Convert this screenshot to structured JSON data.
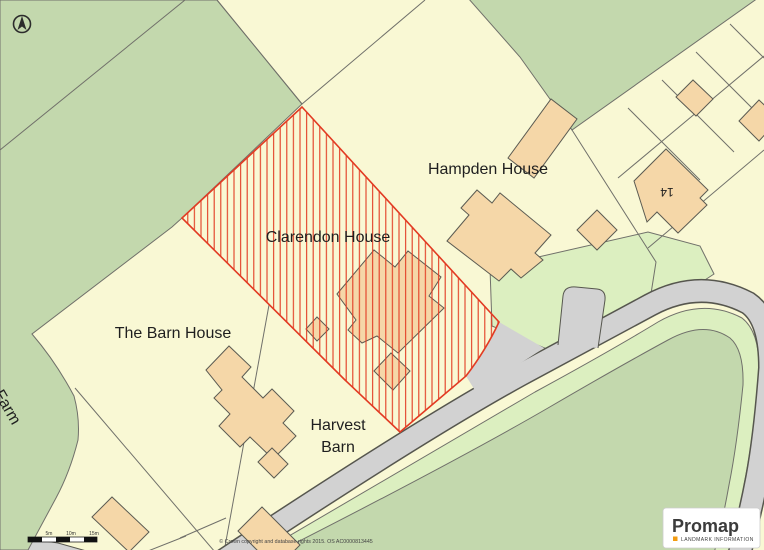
{
  "map": {
    "labels": {
      "hampden_house": "Hampden House",
      "clarendon_house": "Clarendon House",
      "barn_house": "The Barn House",
      "harvest_line1": "Harvest",
      "harvest_line2": "Barn",
      "plot_14": "14",
      "elm_tree_farm": "Elm Tree Farm",
      "partial_road_name": "lella"
    },
    "colors": {
      "parcel_cream": "#f9f8d4",
      "field_green": "#c3d8ad",
      "verge_green": "#dcefc0",
      "road_gray": "#d2d2d2",
      "road_edge": "#56564e",
      "boundary_line": "#70706a",
      "building_fill": "#f5d7a8",
      "selection_red": "#e23b23",
      "logo_accent_orange": "#f39c12"
    }
  },
  "scalebar": {
    "labels": [
      "5m",
      "10m",
      "15m"
    ]
  },
  "copyright": "© Crown copyright and database rights 2015. OS AC0000813445",
  "logo": {
    "name": "Promap",
    "tagline": "LANDMARK INFORMATION"
  }
}
